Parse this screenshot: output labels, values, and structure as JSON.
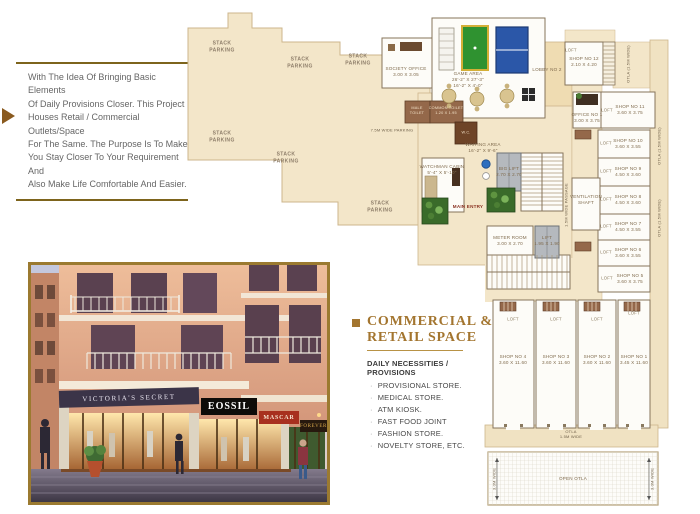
{
  "intro": {
    "lines": [
      "With The Idea Of Bringing Basic Elements",
      "Of Daily Provisions Closer. This Project",
      "Houses Retail / Commercial Outlets/Space",
      "For The Same. The Purpose Is To Make",
      "You Stay Closer To Your Requirement And",
      "Also Make Life Comfortable And Easier."
    ]
  },
  "section": {
    "title_line1": "COMMERCIAL &",
    "title_line2": "RETAIL SPACE",
    "subtitle": "DAILY NECESSITIES / PROVISIONS",
    "items": [
      "PROVISIONAL STORE.",
      "MEDICAL STORE.",
      "ATM KIOSK.",
      "FAST FOOD JOINT",
      "FASHION STORE.",
      "NOVELTY STORE, ETC."
    ]
  },
  "render": {
    "signs": [
      "VICTORIA'S SECRET",
      "EOSSIL",
      "MASCAR",
      "FOREVER"
    ]
  },
  "plan": {
    "stack_parking": "STACK\nPARKING",
    "aisle_label": "7.5M WIDE PARKING",
    "passage_label": "1.5M WIDE PASSAGE",
    "loft": "LOFT",
    "main_entry": "MAIN ENTRY",
    "otla_vertical": "OTLA (1.5M WIDE)",
    "otla_bottom": "OTLA\n1.5M WIDE",
    "open_otla": "OPEN OTLA",
    "open_otla_dim": "3.0M WIDE",
    "rooms": {
      "society_office": "SOCIETY OFFICE\n3.00 X 3.05",
      "game_area": "GAME AREA\n26'-2\" X 27'-3\"\n16'-2\" X 4'-0\"",
      "lobby2": "LOBBY NO 2",
      "male_toilet": "MALE\nTOILET",
      "common_toilet": "COMMON TOILET\n1.20 X 1.95",
      "wc": "W.C.",
      "waiting": "WAITING AREA\n16'-2\" X 9'-6\"",
      "watchman": "WATCHMAN CABIN\n5'-4\" X 5'-10\"",
      "big_lift": "BIG LIFT\n2.70 X 2.70",
      "meter": "METER ROOM\n3.00 X 2.70",
      "lift": "LIFT\n1.95 X 1.90",
      "vent": "VENTILATION\nSHAFT",
      "shop12": "SHOP NO 12\n2.10 X 4.20",
      "office1": "OFFICE NO 1\n3.00 X 3.75",
      "shop11": "SHOP NO 11\n3.60 X 3.75",
      "shop10": "SHOP NO 10\n3.60 X 3.55",
      "shop9": "SHOP NO 9\n4.50 X 3.60",
      "shop8": "SHOP NO 8\n4.50 X 3.60",
      "shop7": "SHOP NO 7\n4.50 X 3.55",
      "shop6": "SHOP NO 6\n3.60 X 3.55",
      "shop5": "SHOP NO 5\n3.60 X 3.75",
      "shop4": "SHOP NO 4\n3.60 X 11.60",
      "shop3": "SHOP NO 3\n3.60 X 11.60",
      "shop2": "SHOP NO 2\n3.60 X 11.60",
      "shop1": "SHOP NO 1\n3.45 X 11.60"
    }
  },
  "colors": {
    "accent_gold": "#a3752f",
    "rule_brown": "#7d641c",
    "plan_beige": "#f3e6c9",
    "toilet_brown": "#94684a",
    "lift_gray": "#b5b9be",
    "pool_green": "#2f9230",
    "tt_blue": "#2b57a8",
    "sign_red": "#a8301f"
  }
}
